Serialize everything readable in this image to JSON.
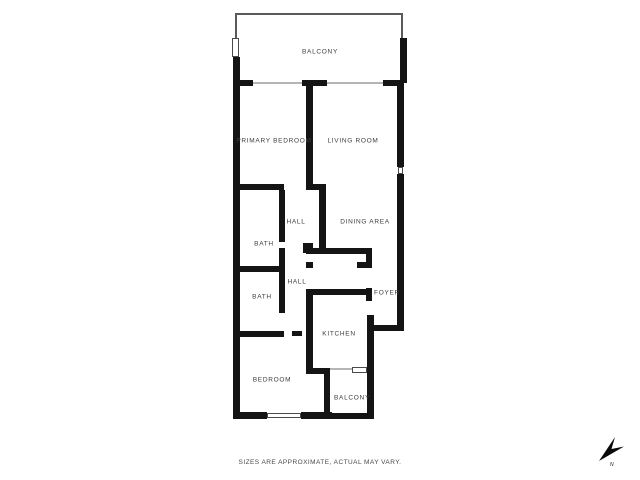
{
  "footer": {
    "disclaimer": "SIZES ARE APPROXIMATE, ACTUAL MAY VARY."
  },
  "compass": {
    "label": "N"
  },
  "colors": {
    "wall": "#141414",
    "label_text": "#3d3d3d",
    "railing": "#5a5a5a",
    "door_line": "#b5b5b5",
    "window_border": "#4a4a4a",
    "background": "#ffffff"
  },
  "floorplan": {
    "rooms": [
      {
        "label": "BALCONY",
        "x": 320,
        "y": 52
      },
      {
        "label": "PRIMARY BEDROOM",
        "x": 274,
        "y": 141
      },
      {
        "label": "LIVING ROOM",
        "x": 353,
        "y": 141
      },
      {
        "label": "HALL",
        "x": 296,
        "y": 222
      },
      {
        "label": "DINING AREA",
        "x": 365,
        "y": 222
      },
      {
        "label": "BATH",
        "x": 264,
        "y": 244
      },
      {
        "label": "HALL",
        "x": 297,
        "y": 282
      },
      {
        "label": "FOYER",
        "x": 387,
        "y": 293
      },
      {
        "label": "BATH",
        "x": 262,
        "y": 297
      },
      {
        "label": "KITCHEN",
        "x": 339,
        "y": 334
      },
      {
        "label": "BEDROOM",
        "x": 272,
        "y": 380
      },
      {
        "label": "BALCONY",
        "x": 352,
        "y": 398
      }
    ],
    "walls": [
      {
        "x": 233,
        "y": 57,
        "w": 7,
        "h": 356
      },
      {
        "x": 400,
        "y": 38,
        "w": 7,
        "h": 45
      },
      {
        "x": 237,
        "y": 80,
        "w": 16,
        "h": 6
      },
      {
        "x": 302,
        "y": 80,
        "w": 25,
        "h": 6
      },
      {
        "x": 383,
        "y": 80,
        "w": 19,
        "h": 6
      },
      {
        "x": 397,
        "y": 83,
        "w": 7,
        "h": 84
      },
      {
        "x": 397,
        "y": 174,
        "w": 7,
        "h": 157
      },
      {
        "x": 306,
        "y": 83,
        "w": 7,
        "h": 107
      },
      {
        "x": 239,
        "y": 184,
        "w": 45,
        "h": 6
      },
      {
        "x": 306,
        "y": 184,
        "w": 20,
        "h": 6
      },
      {
        "x": 279,
        "y": 190,
        "w": 6,
        "h": 52
      },
      {
        "x": 279,
        "y": 248,
        "w": 6,
        "h": 65
      },
      {
        "x": 239,
        "y": 266,
        "w": 40,
        "h": 6
      },
      {
        "x": 319,
        "y": 190,
        "w": 7,
        "h": 64
      },
      {
        "x": 303,
        "y": 243,
        "w": 10,
        "h": 10
      },
      {
        "x": 306,
        "y": 248,
        "w": 66,
        "h": 6
      },
      {
        "x": 306,
        "y": 262,
        "w": 7,
        "h": 6
      },
      {
        "x": 357,
        "y": 262,
        "w": 15,
        "h": 6
      },
      {
        "x": 366,
        "y": 248,
        "w": 6,
        "h": 20
      },
      {
        "x": 366,
        "y": 288,
        "w": 6,
        "h": 13
      },
      {
        "x": 307,
        "y": 289,
        "w": 60,
        "h": 6
      },
      {
        "x": 306,
        "y": 289,
        "w": 7,
        "h": 85
      },
      {
        "x": 374,
        "y": 325,
        "w": 30,
        "h": 6
      },
      {
        "x": 367,
        "y": 315,
        "w": 7,
        "h": 104
      },
      {
        "x": 236,
        "y": 331,
        "w": 48,
        "h": 6
      },
      {
        "x": 292,
        "y": 331,
        "w": 10,
        "h": 5
      },
      {
        "x": 306,
        "y": 368,
        "w": 24,
        "h": 6
      },
      {
        "x": 324,
        "y": 374,
        "w": 6,
        "h": 45
      },
      {
        "x": 324,
        "y": 413,
        "w": 44,
        "h": 6
      },
      {
        "x": 233,
        "y": 412,
        "w": 34,
        "h": 7
      },
      {
        "x": 301,
        "y": 412,
        "w": 31,
        "h": 7
      }
    ],
    "windows": [
      {
        "x": 232,
        "y": 38,
        "w": 7,
        "h": 19
      },
      {
        "x": 398,
        "y": 167,
        "w": 5,
        "h": 7
      },
      {
        "x": 352,
        "y": 367,
        "w": 15,
        "h": 6
      },
      {
        "x": 267,
        "y": 413,
        "w": 34,
        "h": 5
      }
    ],
    "thin_lines": [
      {
        "x": 235,
        "y": 13,
        "w": 168,
        "h": 2,
        "color": "#5a5a5a"
      },
      {
        "x": 235,
        "y": 15,
        "w": 2,
        "h": 23,
        "color": "#5a5a5a"
      },
      {
        "x": 401,
        "y": 15,
        "w": 2,
        "h": 23,
        "color": "#5a5a5a"
      },
      {
        "x": 253,
        "y": 82,
        "w": 49,
        "h": 2,
        "color": "#b5b5b5"
      },
      {
        "x": 327,
        "y": 82,
        "w": 56,
        "h": 2,
        "color": "#b5b5b5"
      },
      {
        "x": 330,
        "y": 368,
        "w": 22,
        "h": 2,
        "color": "#b5b5b5"
      }
    ]
  }
}
